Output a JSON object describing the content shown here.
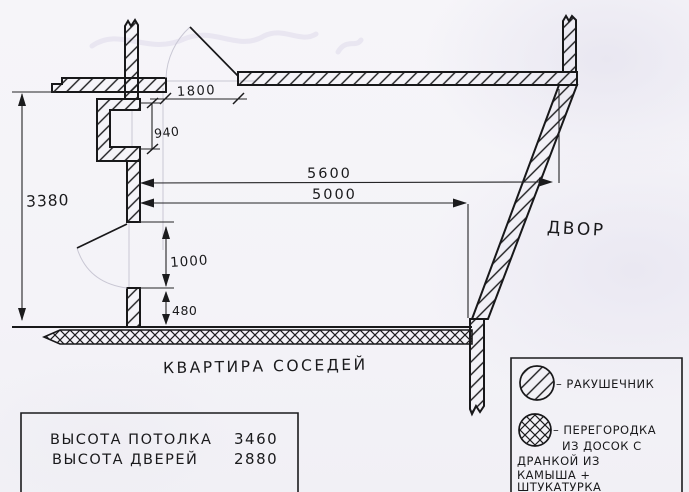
{
  "drawing": {
    "dimensions": {
      "top_door_width": "1800",
      "niche_height": "940",
      "left_total": "3380",
      "span_outer": "5600",
      "span_inner": "5000",
      "bottom_door_opening": "1000",
      "bottom_stub": "480"
    },
    "labels": {
      "courtyard": "Двор",
      "neighbors_apartment": "Квартира соседей"
    },
    "notes": {
      "line1_label": "Высота потолка",
      "line1_value": "3460",
      "line2_label": "Высота дверей",
      "line2_value": "2880"
    },
    "legend": {
      "item1_label": "– ракушечник",
      "item2_lines": [
        "– перегородка",
        "из досок с",
        "дранкой из",
        "камыша +",
        "штукатурка"
      ]
    },
    "colors": {
      "ink": "#1b1b1d",
      "paper": "#f5f4f8",
      "pencil": "#c9c7d4"
    }
  }
}
